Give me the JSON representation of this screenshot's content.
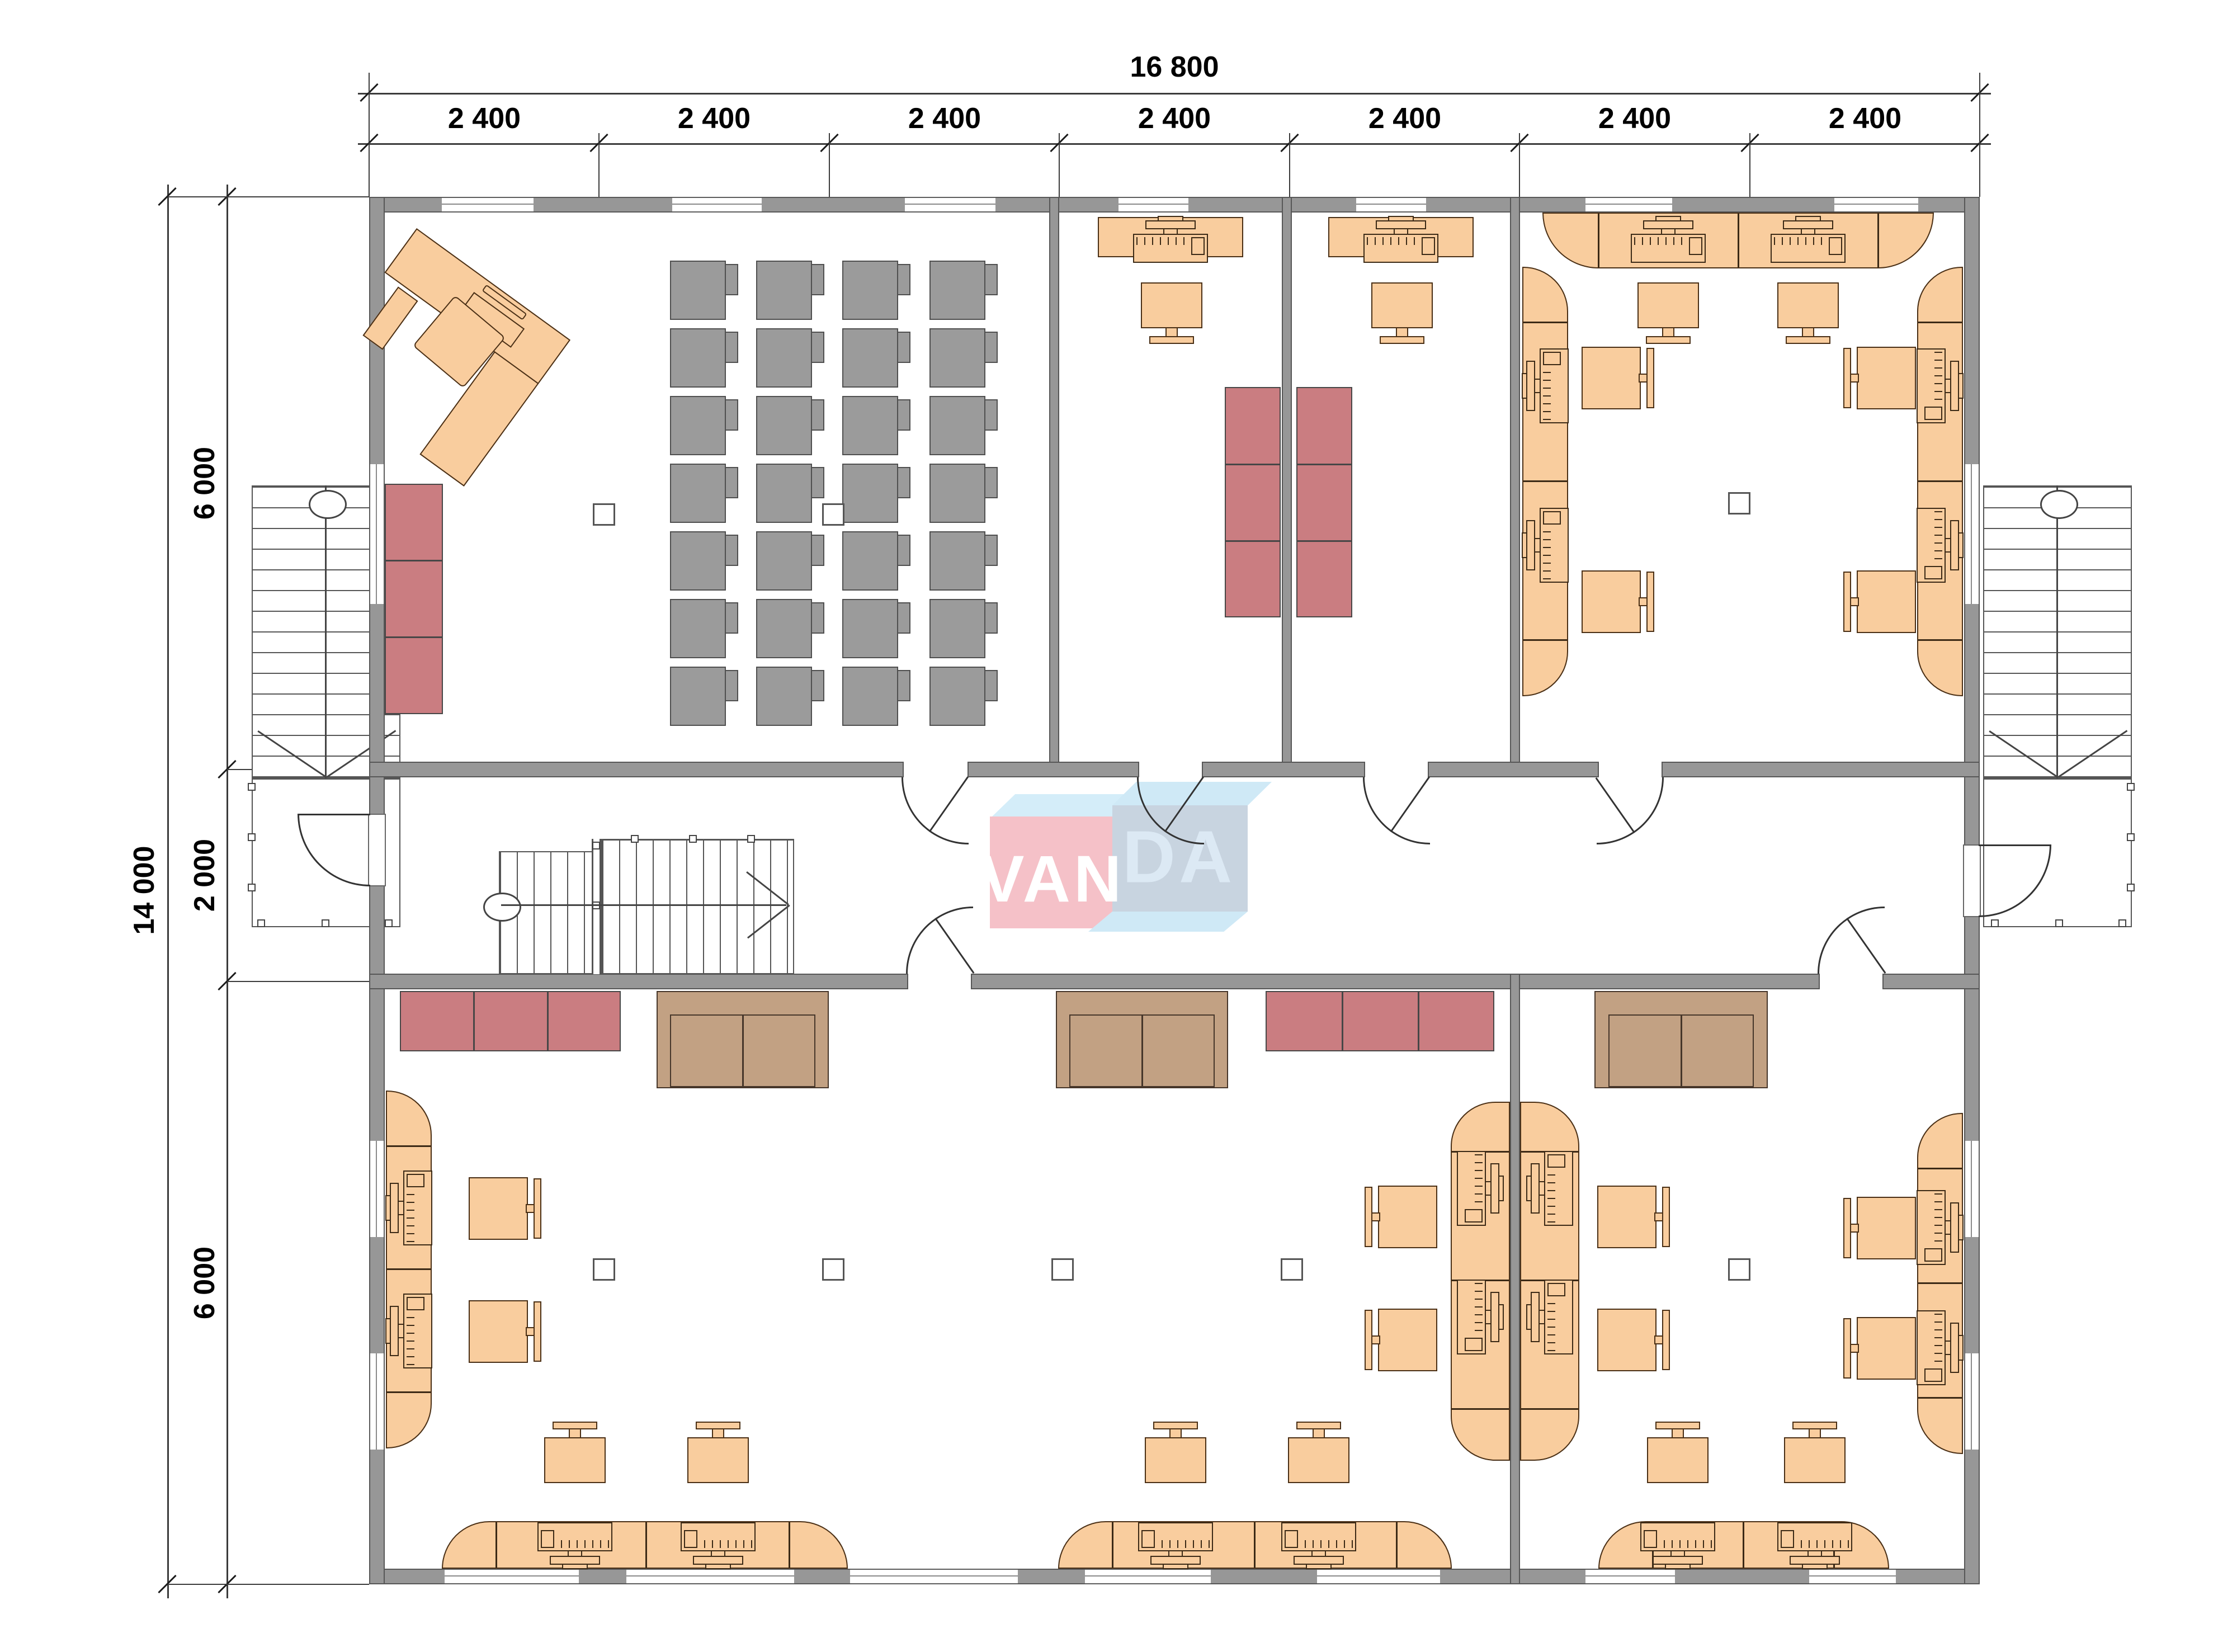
{
  "drawing": {
    "type": "architectural floor plan",
    "units": "mm"
  },
  "watermark": {
    "text_left": "VAN",
    "text_right": "DA"
  },
  "dimensions": {
    "total_width": "16 800",
    "segments_top": [
      "2 400",
      "2 400",
      "2 400",
      "2 400",
      "2 400",
      "2 400",
      "2 400"
    ],
    "total_height": "14 000",
    "segments_left": [
      "6 000",
      "2 000",
      "6 000"
    ]
  },
  "colors": {
    "wall": "#979797",
    "furniture_wood": "#f9cd9e",
    "cabinet_red": "#ca7d81",
    "sofa_brown": "#c2a183",
    "seat_gray": "#9b9b9b",
    "watermark_pink": "#f5c1c8",
    "watermark_blue_light": "#cfe9f6",
    "watermark_blue_face": "#c8d4e0"
  },
  "inventory": {
    "classroom_seats": 28,
    "computer_workstations": 22,
    "standalone_monitors": 4,
    "task_chairs": 18,
    "red_cabinets": 3,
    "red_meeting_tables": 2,
    "brown_sofas": 3,
    "staircases_exterior": 2,
    "staircases_interior": 1
  }
}
